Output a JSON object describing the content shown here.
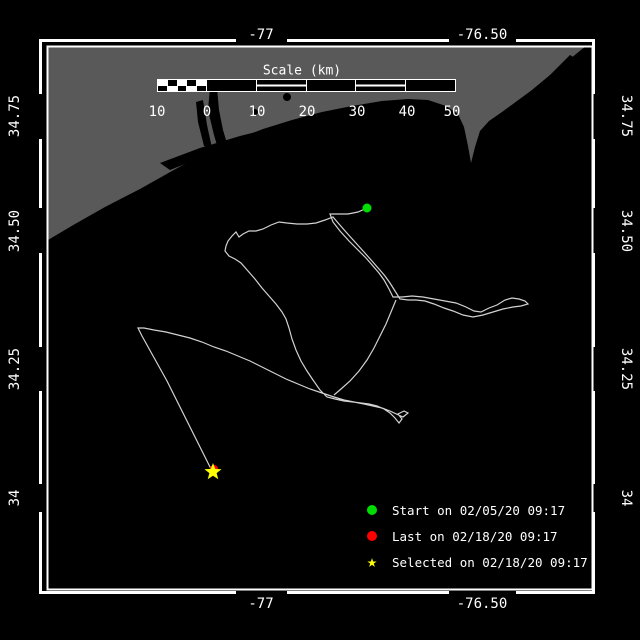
{
  "window": {
    "title": "Drifter track plot"
  },
  "colors": {
    "background": "#000000",
    "land": "#595959",
    "water": "#000000",
    "track": "#d2d2d2",
    "frame": "#ffffff",
    "start_marker": "#00dd00",
    "last_marker": "#ff0000",
    "selected_marker": "#ffff00",
    "text": "#ffffff"
  },
  "axes": {
    "lon_ticks": [
      {
        "label": "-77",
        "x": 261
      },
      {
        "label": "-76.50",
        "x": 482
      }
    ],
    "lat_ticks": [
      {
        "label": "34.75",
        "y": 116
      },
      {
        "label": "34.50",
        "y": 231
      },
      {
        "label": "34.25",
        "y": 369
      },
      {
        "label": "34",
        "y": 498
      }
    ]
  },
  "scale_bar": {
    "title": "Scale (km)",
    "ticks": [
      "10",
      "0",
      "10",
      "20",
      "30",
      "40",
      "50"
    ],
    "tick_x": [
      157,
      207,
      257,
      307,
      357,
      407,
      452
    ]
  },
  "legend": {
    "items": [
      {
        "marker": "circle",
        "color": "#00dd00",
        "label": "Start on 02/05/20 09:17"
      },
      {
        "marker": "circle",
        "color": "#ff0000",
        "label": "Last on 02/18/20 09:17"
      },
      {
        "marker": "star",
        "color": "#ffff00",
        "label": "Selected on 02/18/20 09:17"
      }
    ]
  },
  "chart_data": {
    "type": "map-track",
    "lon_range": [
      -77.49,
      -76.25
    ],
    "lat_range": [
      33.79,
      34.99
    ],
    "markers": {
      "start": {
        "x": 367,
        "y": 208,
        "color": "#00dd00",
        "label": "Start on 02/05/20 09:17"
      },
      "last": {
        "x": 214,
        "y": 469,
        "color": "#ff0000",
        "label": "Last on 02/18/20 09:17"
      },
      "selected": {
        "x": 213,
        "y": 472,
        "color": "#ffff00",
        "label": "Selected on 02/18/20 09:17"
      }
    },
    "track_main": [
      [
        367,
        208
      ],
      [
        358,
        212
      ],
      [
        348,
        214
      ],
      [
        338,
        214
      ],
      [
        330,
        214
      ],
      [
        333,
        222
      ],
      [
        340,
        231
      ],
      [
        349,
        241
      ],
      [
        358,
        250
      ],
      [
        366,
        258
      ],
      [
        373,
        266
      ],
      [
        379,
        273
      ],
      [
        384,
        280
      ],
      [
        389,
        289
      ],
      [
        393,
        297
      ],
      [
        402,
        297
      ],
      [
        412,
        296
      ],
      [
        423,
        297
      ],
      [
        434,
        299
      ],
      [
        445,
        301
      ],
      [
        456,
        303
      ],
      [
        466,
        307
      ],
      [
        474,
        311
      ],
      [
        481,
        312
      ],
      [
        489,
        308
      ],
      [
        497,
        305
      ],
      [
        505,
        300
      ],
      [
        512,
        298
      ],
      [
        519,
        299
      ],
      [
        525,
        301
      ],
      [
        528,
        304
      ],
      [
        521,
        306
      ],
      [
        513,
        307
      ],
      [
        503,
        309
      ],
      [
        493,
        312
      ],
      [
        483,
        315
      ],
      [
        473,
        317
      ],
      [
        463,
        315
      ],
      [
        453,
        311
      ],
      [
        444,
        308
      ],
      [
        434,
        304
      ],
      [
        425,
        301
      ],
      [
        416,
        300
      ],
      [
        408,
        300
      ],
      [
        400,
        299
      ],
      [
        395,
        291
      ],
      [
        390,
        283
      ],
      [
        385,
        276
      ],
      [
        379,
        269
      ],
      [
        372,
        261
      ],
      [
        364,
        252
      ],
      [
        355,
        242
      ],
      [
        346,
        232
      ],
      [
        339,
        224
      ],
      [
        333,
        217
      ],
      [
        325,
        220
      ],
      [
        316,
        223
      ],
      [
        307,
        224
      ],
      [
        297,
        224
      ],
      [
        287,
        223
      ],
      [
        279,
        222
      ],
      [
        271,
        225
      ],
      [
        263,
        229
      ],
      [
        256,
        231
      ],
      [
        249,
        231
      ],
      [
        243,
        234
      ],
      [
        239,
        237
      ],
      [
        236,
        232
      ],
      [
        232,
        236
      ],
      [
        228,
        241
      ],
      [
        226,
        246
      ],
      [
        225,
        251
      ],
      [
        229,
        256
      ],
      [
        235,
        259
      ],
      [
        241,
        263
      ],
      [
        248,
        271
      ],
      [
        255,
        279
      ],
      [
        262,
        288
      ],
      [
        269,
        296
      ],
      [
        276,
        304
      ],
      [
        282,
        312
      ],
      [
        286,
        319
      ],
      [
        289,
        328
      ],
      [
        292,
        339
      ],
      [
        296,
        350
      ],
      [
        301,
        361
      ],
      [
        307,
        371
      ],
      [
        313,
        380
      ],
      [
        320,
        390
      ],
      [
        327,
        397
      ],
      [
        335,
        399
      ],
      [
        344,
        401
      ],
      [
        353,
        402
      ],
      [
        361,
        403
      ],
      [
        369,
        404
      ],
      [
        377,
        406
      ],
      [
        384,
        409
      ],
      [
        390,
        413
      ],
      [
        395,
        418
      ],
      [
        399,
        423
      ],
      [
        402,
        419
      ],
      [
        398,
        414
      ],
      [
        404,
        411
      ],
      [
        408,
        413
      ],
      [
        403,
        417
      ],
      [
        390,
        411
      ],
      [
        382,
        408
      ],
      [
        373,
        406
      ],
      [
        364,
        404
      ],
      [
        354,
        402
      ],
      [
        344,
        400
      ],
      [
        334,
        397
      ],
      [
        322,
        393
      ],
      [
        310,
        389
      ],
      [
        298,
        384
      ],
      [
        286,
        379
      ],
      [
        274,
        373
      ],
      [
        262,
        367
      ],
      [
        250,
        361
      ],
      [
        238,
        356
      ],
      [
        226,
        351
      ],
      [
        214,
        347
      ],
      [
        202,
        342
      ],
      [
        190,
        338
      ],
      [
        178,
        335
      ],
      [
        166,
        332
      ],
      [
        154,
        330
      ],
      [
        144,
        328
      ],
      [
        138,
        328
      ],
      [
        142,
        336
      ],
      [
        147,
        345
      ],
      [
        152,
        354
      ],
      [
        157,
        363
      ],
      [
        162,
        372
      ],
      [
        167,
        381
      ],
      [
        171,
        389
      ],
      [
        175,
        397
      ],
      [
        179,
        405
      ],
      [
        183,
        413
      ],
      [
        187,
        421
      ],
      [
        191,
        429
      ],
      [
        195,
        437
      ],
      [
        199,
        445
      ],
      [
        203,
        453
      ],
      [
        207,
        461
      ],
      [
        210,
        467
      ],
      [
        213,
        472
      ]
    ],
    "track_branch": [
      [
        396,
        300
      ],
      [
        391,
        312
      ],
      [
        386,
        324
      ],
      [
        380,
        336
      ],
      [
        374,
        348
      ],
      [
        367,
        360
      ],
      [
        359,
        371
      ],
      [
        350,
        381
      ],
      [
        341,
        389
      ],
      [
        334,
        395
      ]
    ]
  }
}
